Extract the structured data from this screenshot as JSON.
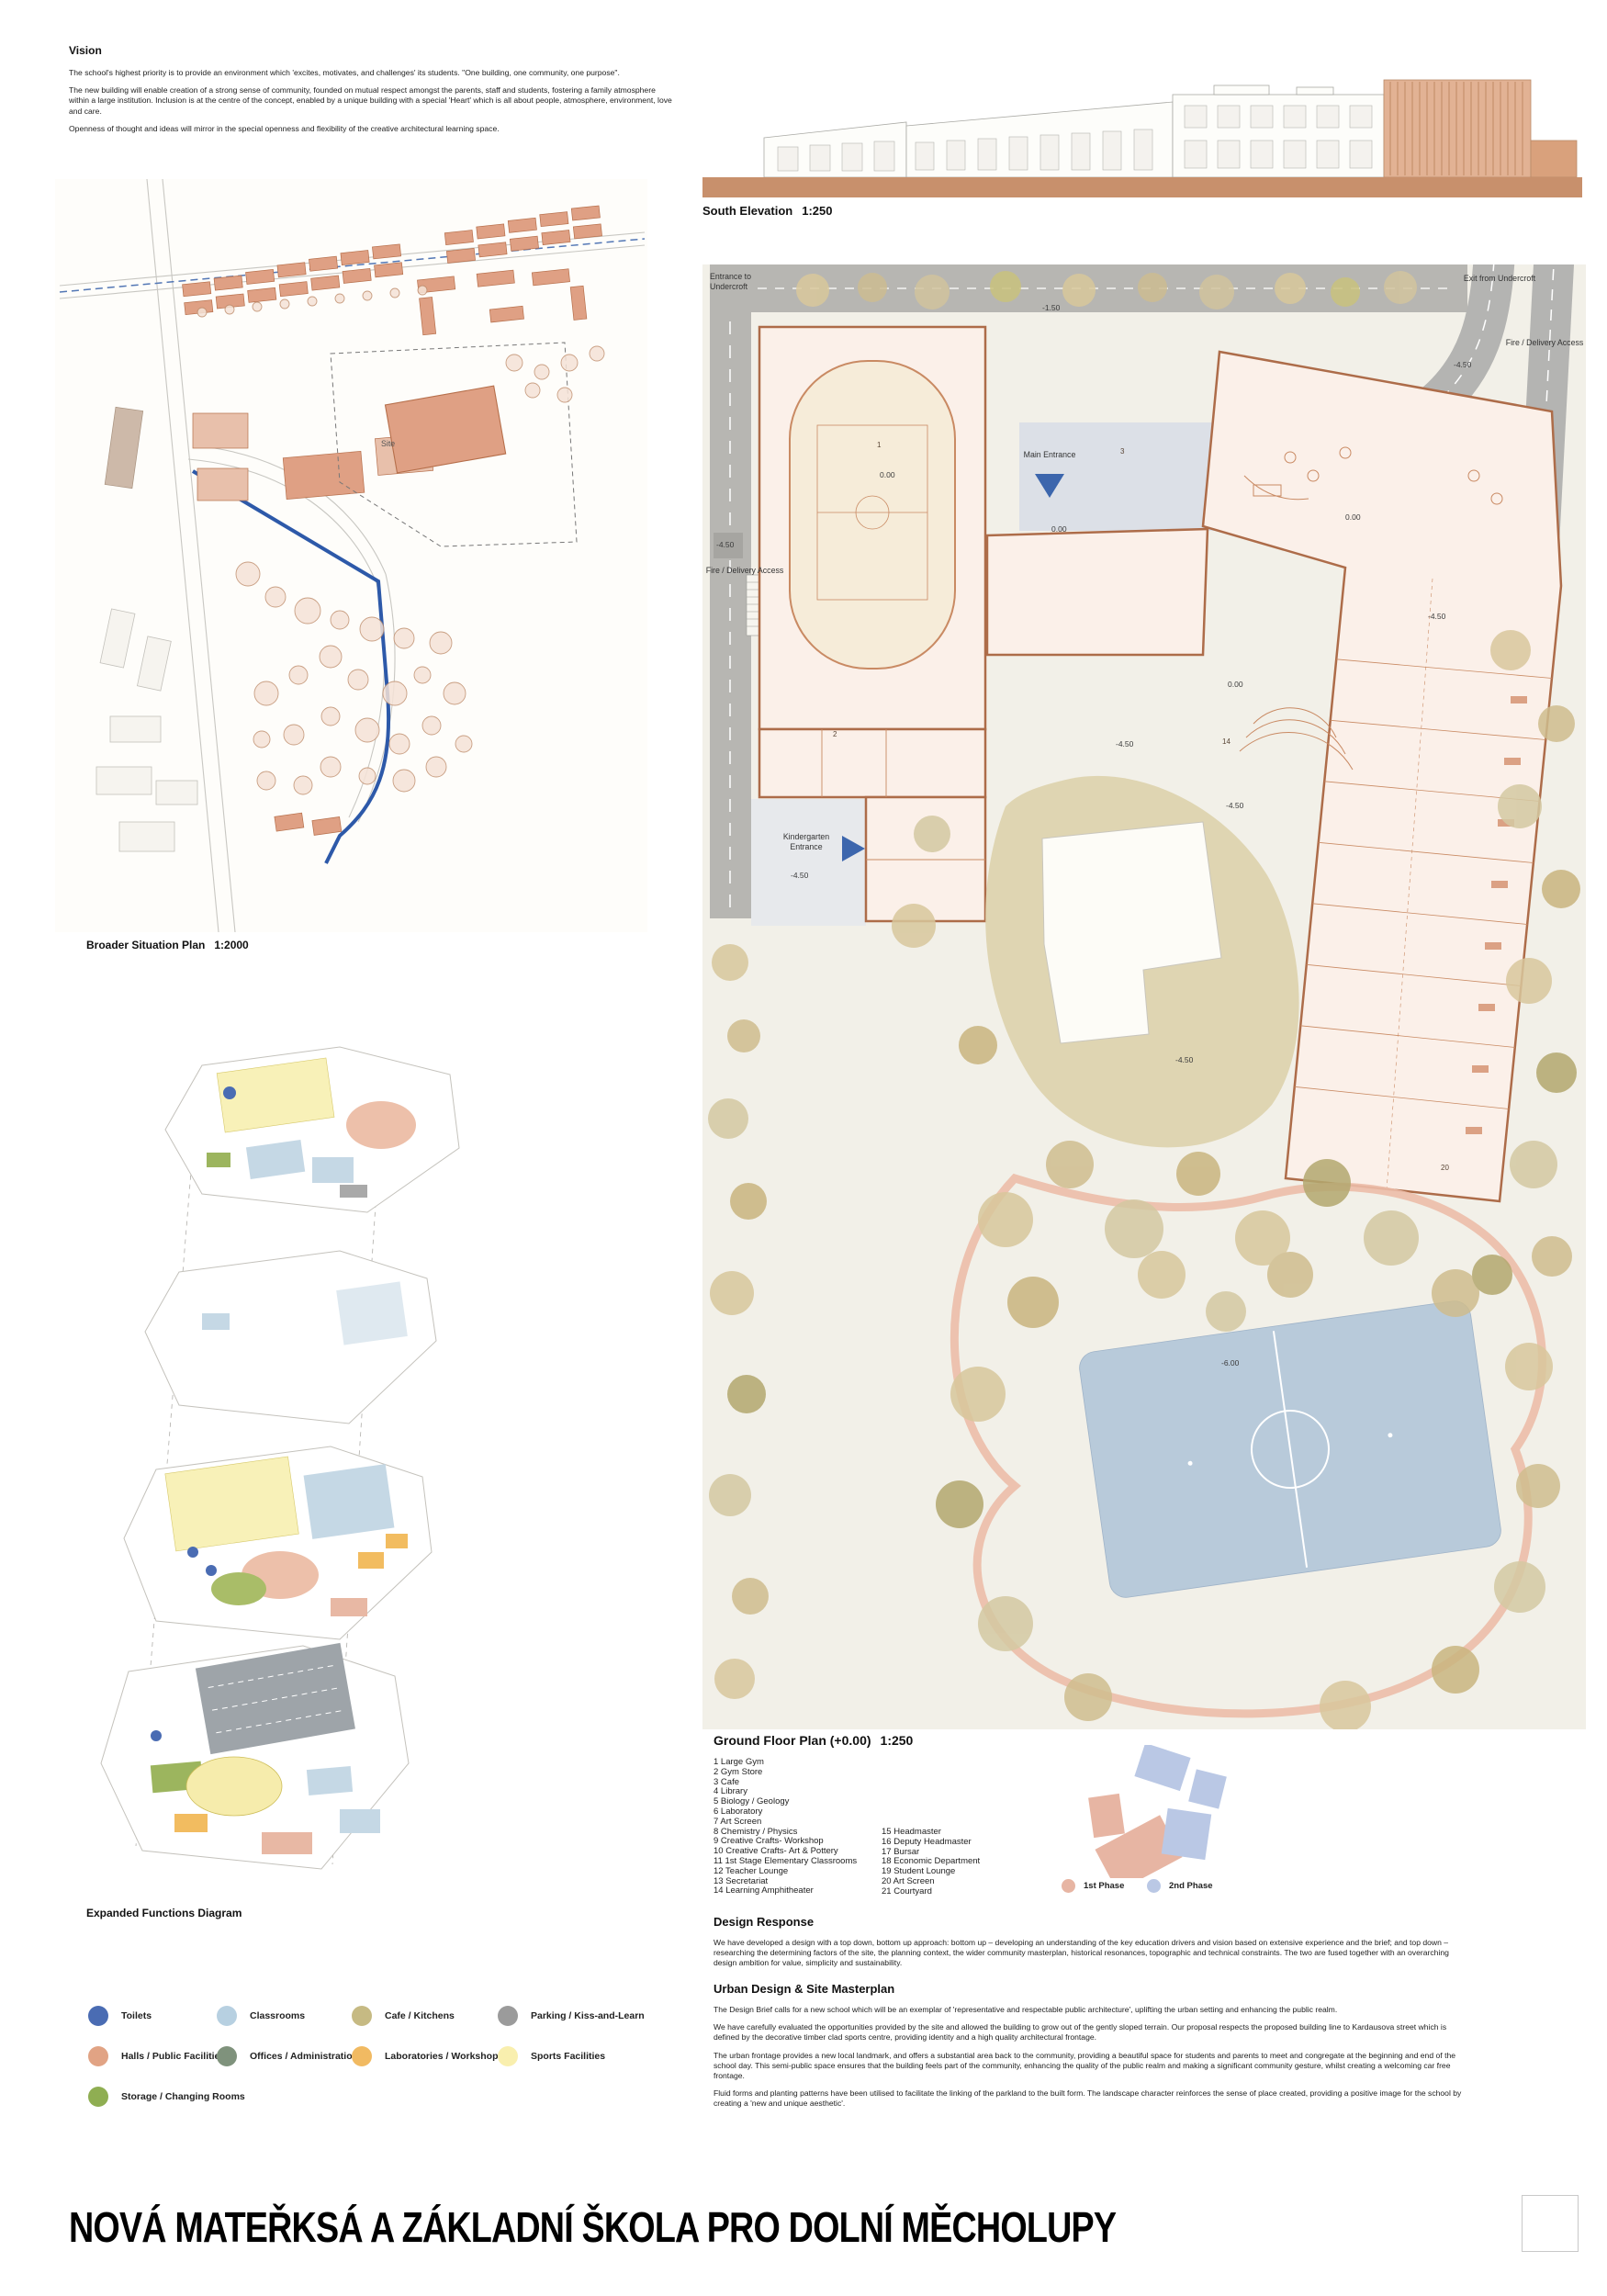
{
  "vision": {
    "title": "Vision",
    "p1": "The school's highest priority is to provide an environment which 'excites, motivates, and challenges' its students. \"One building, one community, one purpose\".",
    "p2": "The new building will enable creation of a strong sense of community, founded on mutual respect amongst the parents, staff and students, fostering a family atmosphere within a large institution. Inclusion is at the centre of the concept, enabled by a unique building with a special 'Heart' which is all about people, atmosphere, environment, love and care.",
    "p3": "Openness of thought and ideas will mirror in the special openness and flexibility of the creative architectural learning space."
  },
  "situation_plan": {
    "caption": "Broader Situation Plan",
    "scale": "1:2000",
    "site_label": "Site"
  },
  "functions_diagram": {
    "caption": "Expanded Functions Diagram"
  },
  "function_legend": {
    "items": [
      {
        "label": "Toilets",
        "color": "#4a6cb3"
      },
      {
        "label": "Classrooms",
        "color": "#b7d0e1"
      },
      {
        "label": "Cafe / Kitchens",
        "color": "#c6ba83"
      },
      {
        "label": "Parking / Kiss-and-Learn",
        "color": "#9b9b9b"
      },
      {
        "label": "Halls / Public Facilities",
        "color": "#e1a384"
      },
      {
        "label": "Offices / Administration",
        "color": "#7f927c"
      },
      {
        "label": "Laboratories / Workshops",
        "color": "#f1ba62"
      },
      {
        "label": "Sports Facilities",
        "color": "#f9efae"
      },
      {
        "label": "Storage / Changing Rooms",
        "color": "#8fae52"
      }
    ]
  },
  "elevation": {
    "caption": "South Elevation",
    "scale": "1:250"
  },
  "ground_plan": {
    "caption": "Ground Floor Plan (+0.00)",
    "scale": "1:250",
    "labels": {
      "entrance_undercroft": "Entrance to Undercroft",
      "exit_undercroft": "Exit from Undercroft",
      "fire_delivery": "Fire / Delivery Access",
      "main_entrance": "Main Entrance",
      "kindergarten_entrance": "Kindergarten Entrance"
    },
    "levels": {
      "l1": "-1.50",
      "l2": "0.00",
      "l3": "0.00",
      "l4": "0.00",
      "l5": "-4.50",
      "l6": "-4.50",
      "l7": "-4.50",
      "l8": "0.00",
      "l9": "-4.50",
      "l10": "-4.50",
      "l11": "-4.50",
      "l12": "-4.50",
      "l13": "-6.00"
    },
    "rooms": {
      "r1": "1",
      "r2": "2",
      "r3": "3",
      "r4": "14",
      "r5": "20"
    },
    "key_col1": [
      "1 Large Gym",
      "2 Gym Store",
      "3 Cafe",
      "4 Library",
      "5 Biology / Geology",
      "6 Laboratory",
      "7 Art Screen",
      "8 Chemistry / Physics",
      "9 Creative Crafts- Workshop",
      "10 Creative Crafts- Art & Pottery",
      "11 1st Stage Elementary Classrooms",
      "12 Teacher Lounge",
      "13 Secretariat",
      "14 Learning Amphitheater"
    ],
    "key_col2": [
      "15 Headmaster",
      "16 Deputy Headmaster",
      "17 Bursar",
      "18 Economic Department",
      "19 Student Lounge",
      "20 Art Screen",
      "21 Courtyard"
    ]
  },
  "phases": {
    "first_label": "1st Phase",
    "second_label": "2nd Phase",
    "first_color": "#e7b5a3",
    "second_color": "#bac8e5"
  },
  "design_response": {
    "title": "Design Response",
    "p1": "We have developed a design with a top down, bottom up approach: bottom up – developing an understanding of the key education drivers and vision based on extensive experience and the brief; and top down – researching the determining factors of the site, the planning context, the wider community masterplan, historical resonances, topographic and technical constraints. The two are fused together with an overarching design ambition for value, simplicity and sustainability."
  },
  "urban_design": {
    "title": "Urban Design & Site Masterplan",
    "p1": "The Design Brief calls for a new school which will be an exemplar of 'representative and respectable public architecture', uplifting the urban setting and enhancing the public realm.",
    "p2": "We have carefully evaluated the opportunities provided by the site and allowed the building to grow out of the gently sloped terrain. Our proposal respects the proposed building line to Kardausova street which is defined by the decorative timber clad sports centre, providing identity and a high quality architectural frontage.",
    "p3": "The urban frontage provides a new local landmark, and offers a substantial area back to the community, providing a beautiful space for students and parents to meet and congregate at the beginning and end of the school day. This semi-public space ensures that the building feels part of the community, enhancing the quality of the public realm and making a significant community gesture, whilst creating a welcoming car free frontage.",
    "p4": "Fluid forms and planting patterns have been utilised to facilitate the linking of the parkland to the built form. The landscape character reinforces the sense of place created, providing a positive image for the school by creating a 'new and unique aesthetic'."
  },
  "footer": {
    "title": "NOVÁ MATEŘKSÁ A ZÁKLADNÍ ŠKOLA PRO DOLNÍ MĚCHOLUPY"
  }
}
